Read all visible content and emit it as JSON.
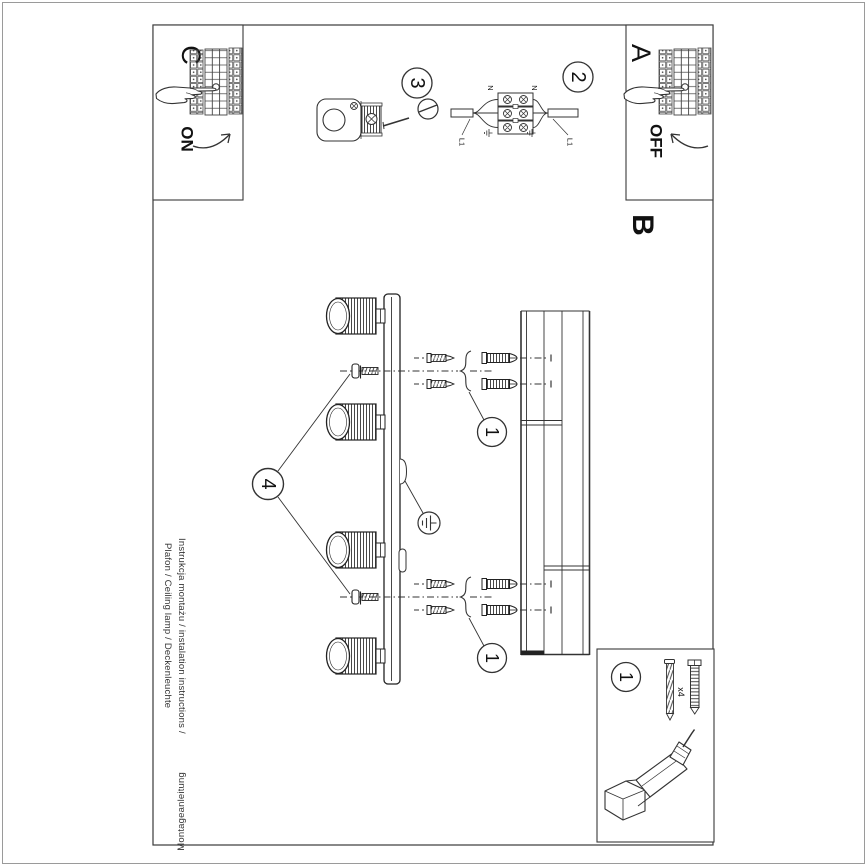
{
  "page": {
    "background": "#ffffff",
    "ink": "#2b2b2b",
    "muted_border": "#9a9a9a"
  },
  "panels": {
    "c": {
      "letter": "C",
      "switch_label": "ON"
    },
    "a": {
      "letter": "A",
      "switch_label": "OFF"
    }
  },
  "section_label": "B",
  "step_numbers": {
    "one": "1",
    "two": "2",
    "three": "3",
    "four": "4"
  },
  "wiring": {
    "neutral": "N",
    "live": "L1"
  },
  "parts": {
    "step": "1",
    "quantity": "x4"
  },
  "footer": {
    "line1": "Instrukcja montażu / instalation instructions / ",
    "line1_flipped": "Montageanleitung",
    "line2": "Plafon / Ceiling lamp / Deckenleuchte"
  }
}
